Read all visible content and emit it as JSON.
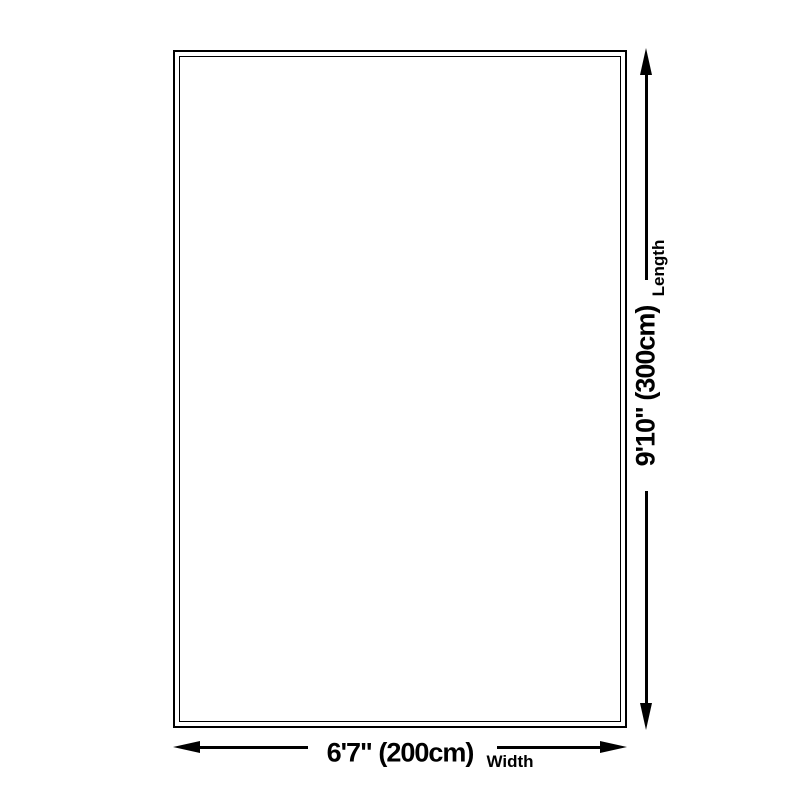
{
  "diagram": {
    "width": {
      "value": "6'7\" (200cm)",
      "label": "Width"
    },
    "length": {
      "value": "9'10\" (300cm)",
      "label": "Length"
    },
    "colors": {
      "line": "#000000",
      "background": "#ffffff"
    }
  }
}
